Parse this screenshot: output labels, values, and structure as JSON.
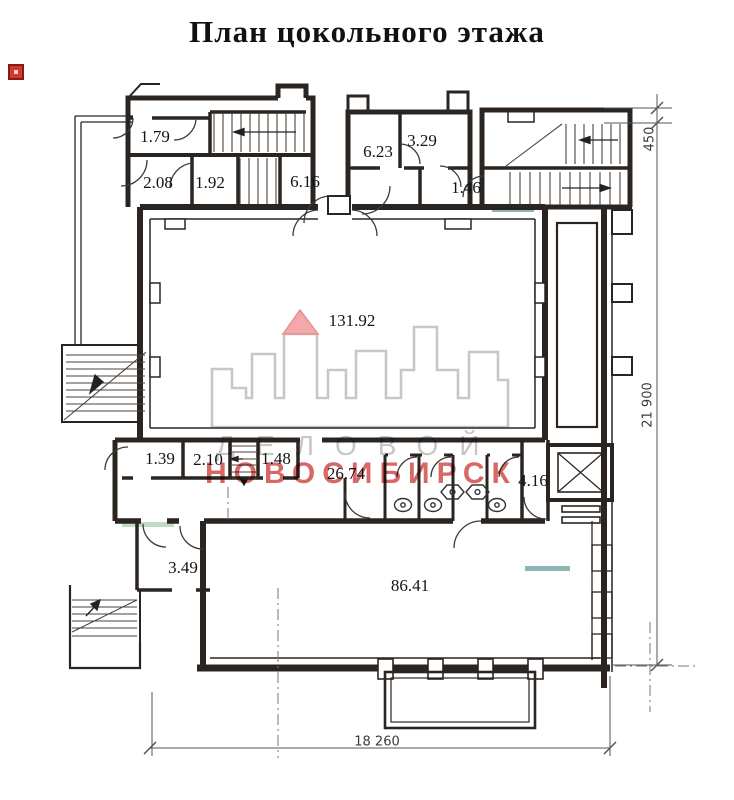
{
  "page": {
    "title": "План цокольного этажа"
  },
  "marker": {
    "name": "red-square-marker",
    "color": "#d03a30"
  },
  "rooms": [
    {
      "id": "r-1-79",
      "area": "1.79"
    },
    {
      "id": "r-2-08",
      "area": "2.08"
    },
    {
      "id": "r-1-92",
      "area": "1.92"
    },
    {
      "id": "r-6-16",
      "area": "6.16"
    },
    {
      "id": "r-6-23",
      "area": "6.23"
    },
    {
      "id": "r-3-29",
      "area": "3.29"
    },
    {
      "id": "r-1-46",
      "area": "1.46"
    },
    {
      "id": "r-131-92",
      "area": "131.92"
    },
    {
      "id": "r-1-39",
      "area": "1.39"
    },
    {
      "id": "r-2-10",
      "area": "2.10"
    },
    {
      "id": "r-1-48",
      "area": "1.48"
    },
    {
      "id": "r-26-74",
      "area": "26.74"
    },
    {
      "id": "r-4-16",
      "area": "4.16"
    },
    {
      "id": "r-3-49",
      "area": "3.49"
    },
    {
      "id": "r-86-41",
      "area": "86.41"
    }
  ],
  "dimensions": [
    {
      "id": "d-450",
      "label": "450"
    },
    {
      "id": "d-21900",
      "label": "21 900"
    },
    {
      "id": "d-18260",
      "label": "18 260"
    }
  ],
  "watermark": {
    "line1": "ДЕЛОВОЙ",
    "line2": "НОВОСИБИРСК",
    "gray_color": "#c7c7c7",
    "red_color": "#c82e2e",
    "triangle_color": "#f3a9a9"
  },
  "legend_icons": {
    "elevator": "crossed-box",
    "toilet": "oval-with-drain",
    "sink": "hexagon-basin",
    "stairs": "hatched-flight-with-arrow"
  },
  "colors": {
    "wall": "#2b2521",
    "dimension": "#555555",
    "paper": "#ffffff"
  }
}
